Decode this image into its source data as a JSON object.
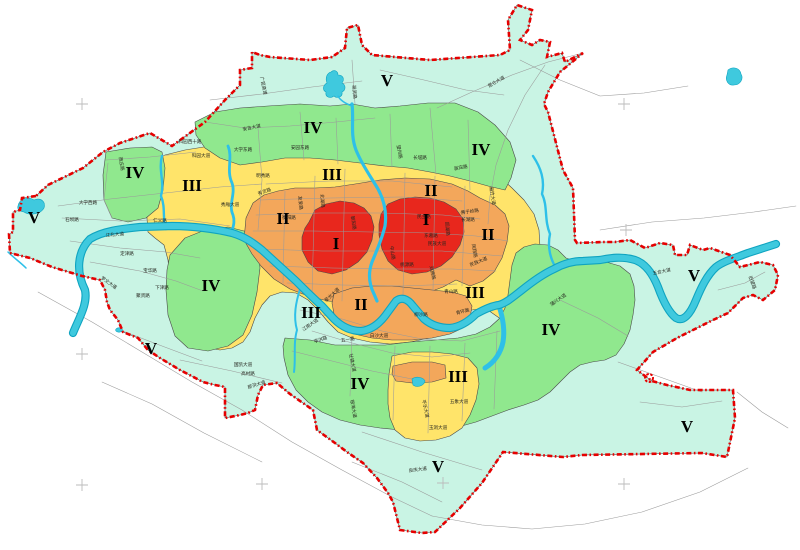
{
  "map": {
    "description": "Urban land-grade zoning map with five graded zones (I centre to V outer), river network, road names and red dashed administrative boundary",
    "grades_visible": [
      "I",
      "II",
      "III",
      "IV",
      "V"
    ]
  },
  "colors": {
    "zone_i": "#E8271D",
    "zone_ii": "#F3A75B",
    "zone_iii": "#FFE46A",
    "zone_iv": "#90E88E",
    "zone_v": "#C9F4E4",
    "river": "#3FC9DE",
    "river_dark": "#0FA4C0",
    "stream": "#2EC0E8",
    "boundary": "#E60000",
    "road": "#9A9A9A",
    "cross": "#BBBBBB",
    "zone_border": "#4A4A4A",
    "label": "#000000"
  },
  "zone_labels": [
    {
      "t": "I",
      "x": 336,
      "y": 249
    },
    {
      "t": "I",
      "x": 426,
      "y": 225
    },
    {
      "t": "II",
      "x": 283,
      "y": 224
    },
    {
      "t": "II",
      "x": 431,
      "y": 196
    },
    {
      "t": "II",
      "x": 488,
      "y": 240
    },
    {
      "t": "II",
      "x": 361,
      "y": 310
    },
    {
      "t": "III",
      "x": 192,
      "y": 191
    },
    {
      "t": "III",
      "x": 332,
      "y": 180
    },
    {
      "t": "III",
      "x": 311,
      "y": 318
    },
    {
      "t": "III",
      "x": 475,
      "y": 298
    },
    {
      "t": "III",
      "x": 458,
      "y": 382
    },
    {
      "t": "IV",
      "x": 135,
      "y": 178
    },
    {
      "t": "IV",
      "x": 313,
      "y": 133
    },
    {
      "t": "IV",
      "x": 481,
      "y": 155
    },
    {
      "t": "IV",
      "x": 211,
      "y": 291
    },
    {
      "t": "IV",
      "x": 360,
      "y": 389
    },
    {
      "t": "IV",
      "x": 551,
      "y": 335
    },
    {
      "t": "V",
      "x": 34,
      "y": 223
    },
    {
      "t": "V",
      "x": 387,
      "y": 86
    },
    {
      "t": "V",
      "x": 151,
      "y": 354
    },
    {
      "t": "V",
      "x": 438,
      "y": 472
    },
    {
      "t": "V",
      "x": 687,
      "y": 432
    },
    {
      "t": "V",
      "x": 694,
      "y": 281
    }
  ],
  "road_labels": [
    {
      "t": "大学西路",
      "x": 88,
      "y": 204,
      "r": 0
    },
    {
      "t": "石坝路",
      "x": 72,
      "y": 221,
      "r": 0
    },
    {
      "t": "仁义路",
      "x": 160,
      "y": 222,
      "r": 0
    },
    {
      "t": "江北大道",
      "x": 115,
      "y": 236,
      "r": -5
    },
    {
      "t": "定津路",
      "x": 127,
      "y": 255,
      "r": 0
    },
    {
      "t": "宝华路",
      "x": 150,
      "y": 272,
      "r": 0
    },
    {
      "t": "下津路",
      "x": 162,
      "y": 289,
      "r": 0
    },
    {
      "t": "聚贤路",
      "x": 143,
      "y": 297,
      "r": 0
    },
    {
      "t": "罗文大道",
      "x": 108,
      "y": 284,
      "r": 35
    },
    {
      "t": "西庄路",
      "x": 120,
      "y": 164,
      "r": 80
    },
    {
      "t": "科园大道",
      "x": 201,
      "y": 157,
      "r": 0
    },
    {
      "t": "科园西十路",
      "x": 190,
      "y": 143,
      "r": 0
    },
    {
      "t": "大学东路",
      "x": 243,
      "y": 151,
      "r": 0
    },
    {
      "t": "明秀路",
      "x": 263,
      "y": 177,
      "r": 0
    },
    {
      "t": "秀厢大道",
      "x": 230,
      "y": 206,
      "r": 0
    },
    {
      "t": "友爱路",
      "x": 299,
      "y": 203,
      "r": 85
    },
    {
      "t": "衡阳路",
      "x": 289,
      "y": 219,
      "r": 0
    },
    {
      "t": "北湖路",
      "x": 321,
      "y": 201,
      "r": 85
    },
    {
      "t": "秀灵路",
      "x": 265,
      "y": 193,
      "r": -20
    },
    {
      "t": "安吉大道",
      "x": 252,
      "y": 129,
      "r": -12
    },
    {
      "t": "邕武路",
      "x": 353,
      "y": 92,
      "r": 85
    },
    {
      "t": "安园东路",
      "x": 300,
      "y": 149,
      "r": 0
    },
    {
      "t": "望州路",
      "x": 398,
      "y": 152,
      "r": 80
    },
    {
      "t": "长堽路",
      "x": 420,
      "y": 159,
      "r": 0
    },
    {
      "t": "邕宾路",
      "x": 461,
      "y": 169,
      "r": -10
    },
    {
      "t": "昆仑大道",
      "x": 497,
      "y": 83,
      "r": -30
    },
    {
      "t": "厢竹大道",
      "x": 491,
      "y": 196,
      "r": 80
    },
    {
      "t": "长湖路",
      "x": 468,
      "y": 221,
      "r": 0
    },
    {
      "t": "民族大道",
      "x": 437,
      "y": 245,
      "r": 0
    },
    {
      "t": "民族大道",
      "x": 479,
      "y": 263,
      "r": -22
    },
    {
      "t": "朝阳路",
      "x": 352,
      "y": 223,
      "r": 82
    },
    {
      "t": "民主路",
      "x": 424,
      "y": 218,
      "r": 0
    },
    {
      "t": "园湖路",
      "x": 446,
      "y": 229,
      "r": 85
    },
    {
      "t": "东葛路",
      "x": 431,
      "y": 237,
      "r": 0
    },
    {
      "t": "中山路",
      "x": 391,
      "y": 253,
      "r": 82
    },
    {
      "t": "桃源路",
      "x": 407,
      "y": 266,
      "r": 0
    },
    {
      "t": "双拥路",
      "x": 431,
      "y": 273,
      "r": 78
    },
    {
      "t": "佛子岭路",
      "x": 470,
      "y": 213,
      "r": -8
    },
    {
      "t": "凤翔路",
      "x": 473,
      "y": 251,
      "r": 80
    },
    {
      "t": "星光大道",
      "x": 333,
      "y": 296,
      "r": -42
    },
    {
      "t": "江南大道",
      "x": 311,
      "y": 326,
      "r": -35
    },
    {
      "t": "五一路",
      "x": 348,
      "y": 341,
      "r": -8
    },
    {
      "t": "白沙大道",
      "x": 379,
      "y": 337,
      "r": 0
    },
    {
      "t": "亭洪路",
      "x": 321,
      "y": 341,
      "r": -18
    },
    {
      "t": "壮锦大道",
      "x": 351,
      "y": 363,
      "r": 78
    },
    {
      "t": "那洪大道",
      "x": 257,
      "y": 386,
      "r": -18
    },
    {
      "t": "国凯大道",
      "x": 243,
      "y": 366,
      "r": 0
    },
    {
      "t": "高村路",
      "x": 248,
      "y": 375,
      "r": 0
    },
    {
      "t": "银海大道",
      "x": 352,
      "y": 409,
      "r": 80
    },
    {
      "t": "平乐大道",
      "x": 424,
      "y": 409,
      "r": 78
    },
    {
      "t": "玉洞大道",
      "x": 438,
      "y": 429,
      "r": 0
    },
    {
      "t": "五象大道",
      "x": 459,
      "y": 403,
      "r": 0
    },
    {
      "t": "青山路",
      "x": 451,
      "y": 293,
      "r": 0
    },
    {
      "t": "青环路",
      "x": 463,
      "y": 313,
      "r": -15
    },
    {
      "t": "柳沙路",
      "x": 421,
      "y": 316,
      "r": 0
    },
    {
      "t": "蒲兴大道",
      "x": 559,
      "y": 301,
      "r": -35
    },
    {
      "t": "五合大道",
      "x": 662,
      "y": 273,
      "r": -12
    },
    {
      "t": "旧望路",
      "x": 751,
      "y": 283,
      "r": 70
    },
    {
      "t": "良庆大道",
      "x": 418,
      "y": 471,
      "r": -8
    },
    {
      "t": "广昆高速",
      "x": 262,
      "y": 86,
      "r": 78
    }
  ],
  "crosses": [
    {
      "x": 82,
      "y": 104
    },
    {
      "x": 624,
      "y": 104
    },
    {
      "x": 626,
      "y": 230
    },
    {
      "x": 82,
      "y": 354
    },
    {
      "x": 82,
      "y": 485
    },
    {
      "x": 262,
      "y": 484
    },
    {
      "x": 443,
      "y": 483
    },
    {
      "x": 624,
      "y": 484
    }
  ]
}
